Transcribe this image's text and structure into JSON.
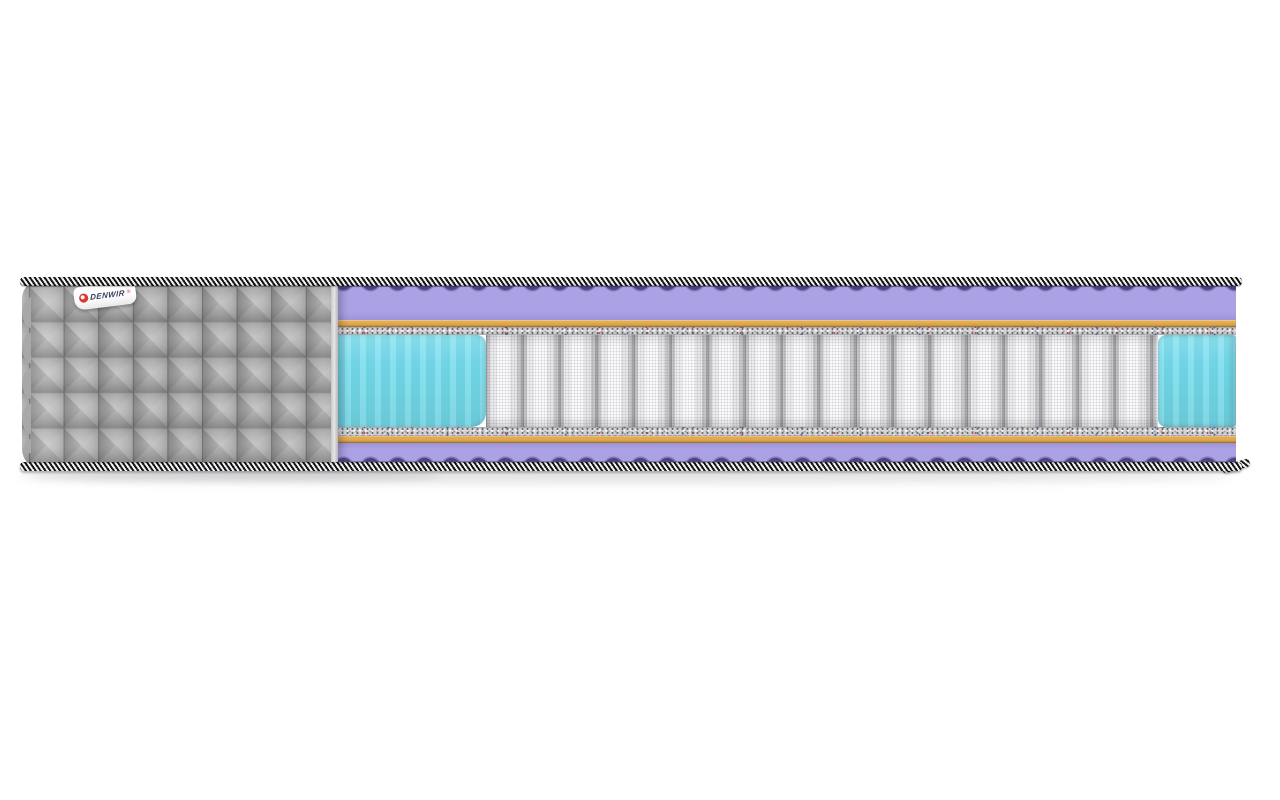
{
  "image_type": "mattress cross-section product render on white background",
  "label": {
    "brand": "DENWIR",
    "mark": "®"
  },
  "colors": {
    "cover": "#a8a8a8",
    "tape-dark": "#161616",
    "tape-light": "#f1f1f1",
    "lilac": "#aba2e6",
    "purple-shadow": "#4e4380",
    "orange": "#dda74e",
    "felt": "#d4d4d6",
    "cyan": "#74dcec",
    "spring-light": "#fafafb",
    "spring-gap": "#98989c",
    "logo-red": "#e0362c",
    "label-text": "#39425f"
  },
  "structure": {
    "sections": [
      "quilted gray fabric cover with brand label (left, wraps around end)",
      "exposed internal layers (right)"
    ],
    "layers_top_to_bottom": [
      "black-and-white striped border tape",
      "lilac wavy massage foam layer",
      "thin orange support layer",
      "speckled felt insulator pad",
      "independent pocket spring block framed by turquoise side foam",
      "speckled felt insulator pad",
      "thin orange support layer",
      "lilac wavy massage foam layer",
      "black-and-white striped border tape"
    ],
    "visible_pocket_springs": 18
  }
}
